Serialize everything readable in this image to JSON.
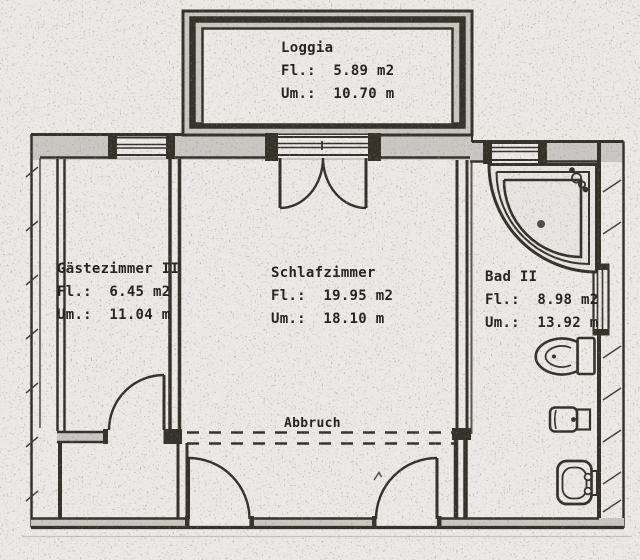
{
  "plan": {
    "rooms": {
      "loggia": {
        "name": "Loggia",
        "area": "Fl.:  5.89 m2",
        "perimeter": "Um.:  10.70 m"
      },
      "gaestezimmer2": {
        "name": "Gästezimmer II",
        "area": "Fl.:  6.45 m2",
        "perimeter": "Um.:  11.04 m"
      },
      "schlafzimmer": {
        "name": "Schlafzimmer",
        "area": "Fl.:  19.95 m2",
        "perimeter": "Um.:  18.10 m"
      },
      "bad2": {
        "name": "Bad II",
        "area": "Fl.:  8.98 m2",
        "perimeter": "Um.:  13.92 m"
      }
    },
    "annotations": {
      "abbruch": "Abbruch"
    },
    "fixtures": [
      "corner-bathtub",
      "toilet",
      "bidet",
      "washbasin"
    ],
    "colors": {
      "ink": "#34312c",
      "paper": "#ebe9e4",
      "wall_fill": "#c9c7c1"
    }
  }
}
